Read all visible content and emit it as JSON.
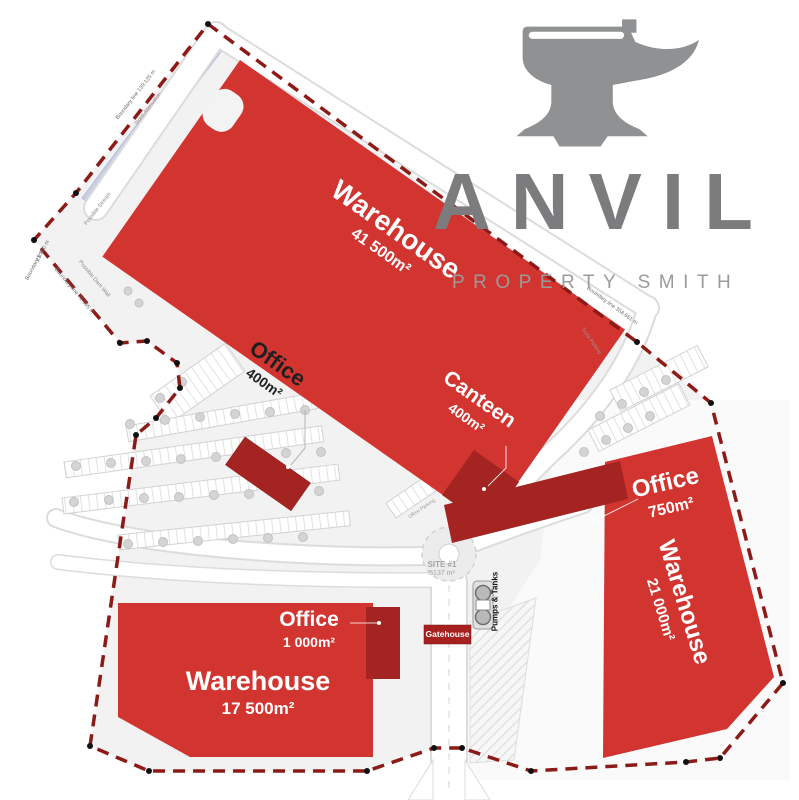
{
  "brand": {
    "name": "ANVIL",
    "tagline": "PROPERTY SMITH"
  },
  "site": {
    "name": "SITE #1",
    "area": "5137 m²"
  },
  "buildings": {
    "warehouse_nw": {
      "label": "Warehouse",
      "area": "41 500m²"
    },
    "canteen": {
      "label": "Canteen",
      "area": "400m²"
    },
    "office_nw": {
      "label": "Office",
      "area": "400m²"
    },
    "office_e": {
      "label": "Office",
      "area": "750m²"
    },
    "warehouse_e": {
      "label": "Warehouse",
      "area": "21 000m²"
    },
    "office_sw": {
      "label": "Office",
      "area": "1 000m²"
    },
    "warehouse_sw": {
      "label": "Warehouse",
      "area": "17 500m²"
    },
    "gatehouse": {
      "label": "Gatehouse"
    },
    "pumps": {
      "label": "Pumps & Tanks"
    }
  },
  "annotations": {
    "boundary_nw": "Boundary line  139.125 m",
    "boundary_ne": "Boundary line  358.661 m",
    "boundary_w_len": "21.300 m",
    "boundary_w_name": "Boundary line",
    "boundary_sw": "Boundary line  72.005 m",
    "dam": "Possible Dam Wall",
    "stream": "Possible Stream",
    "attenuation": "Storm Attenuation",
    "truck_parking": "Truck Parking",
    "office_parking": "Office Parking"
  },
  "colors": {
    "building_red": "#d23430",
    "annex_dark_red": "#a32421",
    "boundary_line": "#8c1b17",
    "logo_gray": "#8f9193",
    "stream_blue": "#c9cfe3"
  }
}
